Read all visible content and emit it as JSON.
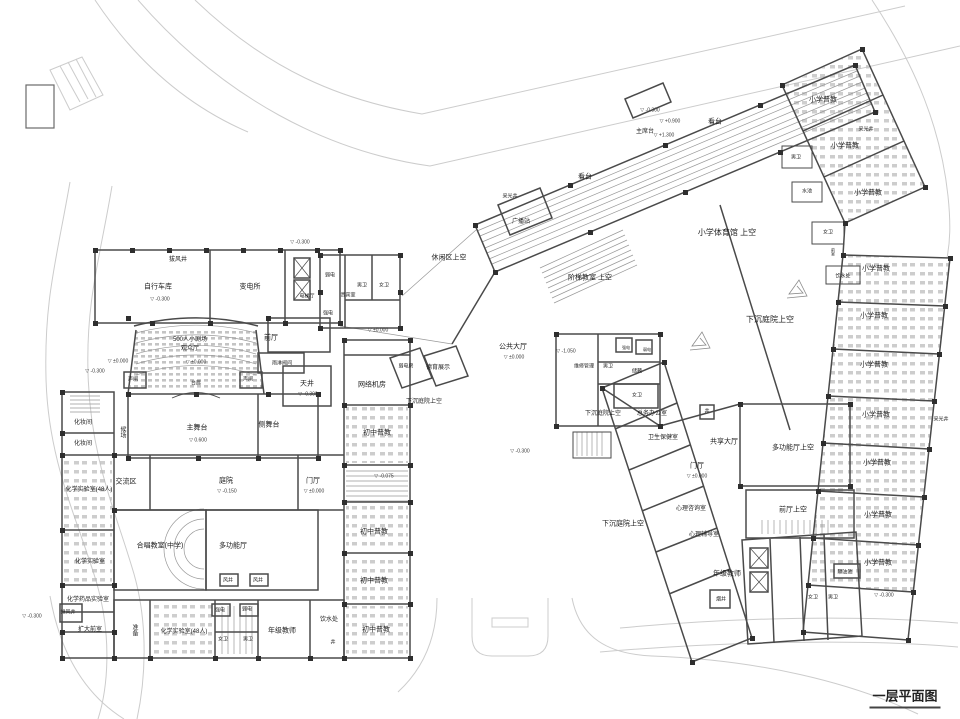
{
  "drawing": {
    "title": "一层平面图",
    "type": "architectural-floor-plan",
    "colors": {
      "walls": "#4a4a4a",
      "light_lines": "#999999",
      "roads": "#cccccc",
      "columns": "#2e2e2e",
      "furniture": "#b9b9b9",
      "text": "#1c1c1c",
      "background": "#ffffff"
    },
    "labels": [
      {
        "t": "拔风井",
        "x": 178,
        "y": 260,
        "fs": 6
      },
      {
        "t": "自行车库",
        "x": 158,
        "y": 287
      },
      {
        "t": "-0.300",
        "x": 160,
        "y": 300,
        "fs": 5,
        "lv": true
      },
      {
        "t": "变电所",
        "x": 250,
        "y": 287
      },
      {
        "t": "电梯厅",
        "x": 307,
        "y": 297,
        "fs": 5
      },
      {
        "t": "弱电",
        "x": 330,
        "y": 276,
        "fs": 5
      },
      {
        "t": "强电",
        "x": 328,
        "y": 314,
        "fs": 5
      },
      {
        "t": "贵宾室",
        "x": 348,
        "y": 296,
        "fs": 5
      },
      {
        "t": "男卫",
        "x": 362,
        "y": 286,
        "fs": 5
      },
      {
        "t": "女卫",
        "x": 384,
        "y": 286,
        "fs": 5
      },
      {
        "t": "±0.000",
        "x": 378,
        "y": 331,
        "fs": 5,
        "lv": true
      },
      {
        "t": "-0.300",
        "x": 300,
        "y": 243,
        "fs": 5,
        "lv": true
      },
      {
        "t": "500人小剧场",
        "x": 190,
        "y": 340,
        "fs": 6
      },
      {
        "t": "观众厅",
        "x": 190,
        "y": 349,
        "fs": 6
      },
      {
        "t": "±0.000",
        "x": 196,
        "y": 363,
        "fs": 5,
        "lv": true
      },
      {
        "t": "前厅",
        "x": 271,
        "y": 338
      },
      {
        "t": "雨淋阀间",
        "x": 282,
        "y": 364,
        "fs": 5
      },
      {
        "t": "声闸",
        "x": 133,
        "y": 380,
        "fs": 5
      },
      {
        "t": "声闸",
        "x": 248,
        "y": 380,
        "fs": 5
      },
      {
        "t": "台唇",
        "x": 196,
        "y": 384,
        "fs": 5
      },
      {
        "t": "天井",
        "x": 307,
        "y": 384
      },
      {
        "t": "-0.300",
        "x": 308,
        "y": 395,
        "fs": 5,
        "lv": true
      },
      {
        "t": "主舞台",
        "x": 197,
        "y": 428
      },
      {
        "t": "0.600",
        "x": 198,
        "y": 441,
        "fs": 5,
        "lv": true
      },
      {
        "t": "侧舞台",
        "x": 269,
        "y": 425
      },
      {
        "t": "化妆间",
        "x": 83,
        "y": 423,
        "fs": 6
      },
      {
        "t": "化妆间",
        "x": 83,
        "y": 444,
        "fs": 6
      },
      {
        "t": "候场",
        "x": 122,
        "y": 432,
        "fs": 6,
        "v": true
      },
      {
        "t": "网络机房",
        "x": 372,
        "y": 385
      },
      {
        "t": "交流区",
        "x": 126,
        "y": 482
      },
      {
        "t": "庭院",
        "x": 226,
        "y": 481
      },
      {
        "t": "-0.150",
        "x": 227,
        "y": 492,
        "fs": 5,
        "lv": true
      },
      {
        "t": "门厅",
        "x": 313,
        "y": 481
      },
      {
        "t": "±0.000",
        "x": 314,
        "y": 492,
        "fs": 5,
        "lv": true
      },
      {
        "t": "化学实验室(48人)",
        "x": 89,
        "y": 490,
        "fs": 6
      },
      {
        "t": "化学实验室",
        "x": 90,
        "y": 562,
        "fs": 6
      },
      {
        "t": "化学药品实验室",
        "x": 88,
        "y": 600,
        "fs": 6
      },
      {
        "t": "排风井",
        "x": 68,
        "y": 613,
        "fs": 5
      },
      {
        "t": "扩大前室",
        "x": 90,
        "y": 630,
        "fs": 6
      },
      {
        "t": "合唱教室(中学)",
        "x": 160,
        "y": 546
      },
      {
        "t": "多功能厅",
        "x": 233,
        "y": 546
      },
      {
        "t": "风井",
        "x": 228,
        "y": 581,
        "fs": 5
      },
      {
        "t": "风井",
        "x": 258,
        "y": 581,
        "fs": 5
      },
      {
        "t": "准备",
        "x": 134,
        "y": 630,
        "fs": 6,
        "v": true
      },
      {
        "t": "化学实验室(48人)",
        "x": 184,
        "y": 632,
        "fs": 6
      },
      {
        "t": "强电",
        "x": 220,
        "y": 611,
        "fs": 5
      },
      {
        "t": "弱电",
        "x": 247,
        "y": 610,
        "fs": 5
      },
      {
        "t": "女卫",
        "x": 223,
        "y": 640,
        "fs": 5
      },
      {
        "t": "男卫",
        "x": 248,
        "y": 640,
        "fs": 5
      },
      {
        "t": "年级教师",
        "x": 282,
        "y": 631
      },
      {
        "t": "饮水处",
        "x": 329,
        "y": 620,
        "fs": 6
      },
      {
        "t": "井",
        "x": 333,
        "y": 643,
        "fs": 5
      },
      {
        "t": "-0.300",
        "x": 32,
        "y": 617,
        "fs": 5,
        "lv": true
      },
      {
        "t": "-0.300",
        "x": 95,
        "y": 372,
        "fs": 5,
        "lv": true
      },
      {
        "t": "±0.000",
        "x": 118,
        "y": 362,
        "fs": 5,
        "lv": true
      },
      {
        "t": "初中普教",
        "x": 377,
        "y": 433
      },
      {
        "t": "-0.075",
        "x": 384,
        "y": 477,
        "fs": 5,
        "lv": true
      },
      {
        "t": "初中普教",
        "x": 374,
        "y": 532
      },
      {
        "t": "初中普教",
        "x": 374,
        "y": 581
      },
      {
        "t": "初中普教",
        "x": 376,
        "y": 630
      },
      {
        "t": "下沉庭院上空",
        "x": 424,
        "y": 402,
        "fs": 6
      },
      {
        "t": "弱电房",
        "x": 406,
        "y": 367,
        "fs": 5
      },
      {
        "t": "德育展示",
        "x": 438,
        "y": 368,
        "fs": 6
      },
      {
        "t": "公共大厅",
        "x": 513,
        "y": 347
      },
      {
        "t": "±0.000",
        "x": 514,
        "y": 358,
        "fs": 5,
        "lv": true
      },
      {
        "t": "休闲区上空",
        "x": 449,
        "y": 258
      },
      {
        "t": "采光井",
        "x": 510,
        "y": 197,
        "fs": 5
      },
      {
        "t": "广播站",
        "x": 521,
        "y": 222,
        "fs": 6
      },
      {
        "t": "阶梯教室 上空",
        "x": 590,
        "y": 278
      },
      {
        "t": "小学体育馆 上空",
        "x": 727,
        "y": 233,
        "fs": 8
      },
      {
        "t": "看台",
        "x": 585,
        "y": 177
      },
      {
        "t": "看台",
        "x": 715,
        "y": 122
      },
      {
        "t": "主席台",
        "x": 645,
        "y": 132,
        "fs": 6
      },
      {
        "t": "-0.300",
        "x": 650,
        "y": 111,
        "fs": 5,
        "lv": true
      },
      {
        "t": "+0.900",
        "x": 670,
        "y": 122,
        "fs": 5,
        "lv": true
      },
      {
        "t": "+1.300",
        "x": 664,
        "y": 136,
        "fs": 5,
        "lv": true
      },
      {
        "t": "下沉庭院上空",
        "x": 770,
        "y": 320,
        "fs": 8
      },
      {
        "t": "维修管理",
        "x": 584,
        "y": 367,
        "fs": 5
      },
      {
        "t": "男卫",
        "x": 608,
        "y": 367,
        "fs": 5
      },
      {
        "t": "储藏",
        "x": 637,
        "y": 372,
        "fs": 5
      },
      {
        "t": "强电",
        "x": 626,
        "y": 348,
        "fs": 4
      },
      {
        "t": "弱电",
        "x": 647,
        "y": 350,
        "fs": 4
      },
      {
        "t": "女卫",
        "x": 637,
        "y": 396,
        "fs": 5
      },
      {
        "t": "-1.050",
        "x": 566,
        "y": 352,
        "fs": 5,
        "lv": true
      },
      {
        "t": "下沉庭院上空",
        "x": 603,
        "y": 414,
        "fs": 6
      },
      {
        "t": "总务办公室",
        "x": 652,
        "y": 414,
        "fs": 6
      },
      {
        "t": "卫生保健室",
        "x": 663,
        "y": 438,
        "fs": 6
      },
      {
        "t": "井",
        "x": 707,
        "y": 412,
        "fs": 5
      },
      {
        "t": "共享大厅",
        "x": 724,
        "y": 442
      },
      {
        "t": "多功能厅上空",
        "x": 793,
        "y": 448
      },
      {
        "t": "门厅",
        "x": 697,
        "y": 466
      },
      {
        "t": "±0.000",
        "x": 697,
        "y": 477,
        "fs": 5,
        "lv": true
      },
      {
        "t": "前厅上空",
        "x": 793,
        "y": 510
      },
      {
        "t": "心理咨询室",
        "x": 691,
        "y": 509,
        "fs": 6
      },
      {
        "t": "心理辅导室",
        "x": 704,
        "y": 535,
        "fs": 6
      },
      {
        "t": "下沉庭院上空",
        "x": 623,
        "y": 524
      },
      {
        "t": "年级教师",
        "x": 727,
        "y": 574
      },
      {
        "t": "烟井",
        "x": 721,
        "y": 600,
        "fs": 5
      },
      {
        "t": "女卫",
        "x": 813,
        "y": 598,
        "fs": 5
      },
      {
        "t": "男卫",
        "x": 833,
        "y": 598,
        "fs": 5
      },
      {
        "t": "隔油池",
        "x": 845,
        "y": 573,
        "fs": 5
      },
      {
        "t": "-0.300",
        "x": 884,
        "y": 596,
        "fs": 5,
        "lv": true
      },
      {
        "t": "小学普教",
        "x": 823,
        "y": 100
      },
      {
        "t": "小学普教",
        "x": 845,
        "y": 146
      },
      {
        "t": "小学普教",
        "x": 868,
        "y": 193
      },
      {
        "t": "采光井",
        "x": 866,
        "y": 130,
        "fs": 5
      },
      {
        "t": "男卫",
        "x": 796,
        "y": 158,
        "fs": 5
      },
      {
        "t": "水池",
        "x": 807,
        "y": 192,
        "fs": 5
      },
      {
        "t": "女卫",
        "x": 828,
        "y": 233,
        "fs": 5
      },
      {
        "t": "前室",
        "x": 833,
        "y": 252,
        "fs": 4,
        "v": true
      },
      {
        "t": "饮水处",
        "x": 843,
        "y": 277,
        "fs": 5
      },
      {
        "t": "小学普教",
        "x": 876,
        "y": 269
      },
      {
        "t": "小学普教",
        "x": 874,
        "y": 316
      },
      {
        "t": "小学普教",
        "x": 874,
        "y": 365
      },
      {
        "t": "小学普教",
        "x": 876,
        "y": 415
      },
      {
        "t": "采光井",
        "x": 941,
        "y": 420,
        "fs": 5
      },
      {
        "t": "小学普教",
        "x": 877,
        "y": 463
      },
      {
        "t": "小学普教",
        "x": 878,
        "y": 515
      },
      {
        "t": "小学普教",
        "x": 878,
        "y": 563
      },
      {
        "t": "-0.300",
        "x": 520,
        "y": 452,
        "fs": 5,
        "lv": true
      }
    ]
  }
}
